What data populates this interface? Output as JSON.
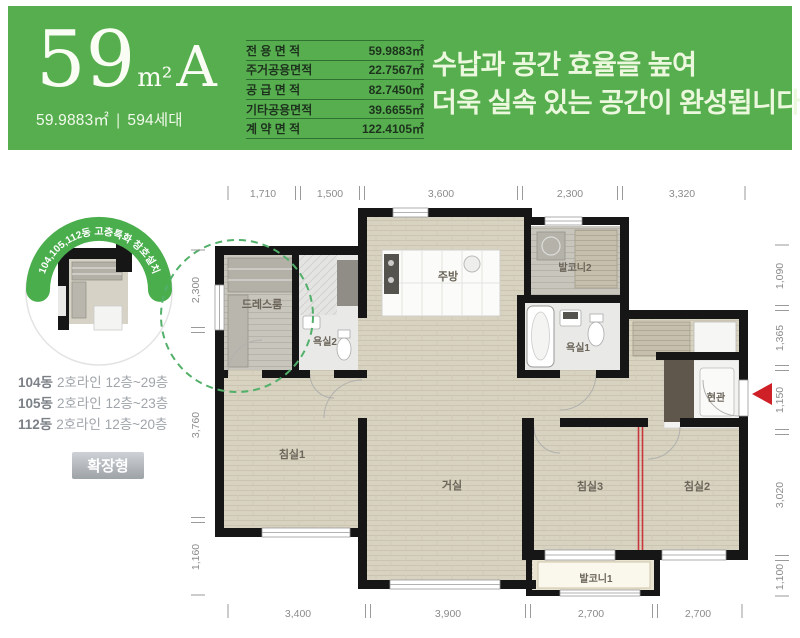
{
  "header": {
    "size_number": "59",
    "size_unit": "m²",
    "size_type": "A",
    "size_detail": "59.9883㎡",
    "divider": "|",
    "households": "594세대",
    "area_table": [
      {
        "label": "전 용 면 적",
        "value": "59.9883㎡"
      },
      {
        "label": "주거공용면적",
        "value": "22.7567㎡"
      },
      {
        "label": "공 급 면 적",
        "value": "82.7450㎡"
      },
      {
        "label": "기타공용면적",
        "value": "39.6655㎡"
      },
      {
        "label": "계 약 면 적",
        "value": "122.4105㎡"
      }
    ],
    "headline_line1": "수납과 공간 효율을 높여",
    "headline_line2": "더욱 실속 있는 공간이 완성됩니다"
  },
  "sidebar": {
    "badge_arc_text": "104,105,112동 고층특화 창호설치",
    "floor_lines": [
      {
        "dong": "104동",
        "detail": "2호라인 12층~29층"
      },
      {
        "dong": "105동",
        "detail": "2호라인 12층~23층"
      },
      {
        "dong": "112동",
        "detail": "2호라인 12층~20층"
      }
    ],
    "type_badge": "확장형"
  },
  "plan": {
    "rooms": {
      "dressroom": "드레스룸",
      "bath2": "욕실2",
      "kitchen": "주방",
      "balcony2": "발코니2",
      "bath1": "욕실1",
      "entrance": "현관",
      "bedroom1": "침실1",
      "living": "거실",
      "bedroom3": "침실3",
      "bedroom2": "침실2",
      "balcony1": "발코니1"
    },
    "dims_top": [
      "1,710",
      "1,500",
      "3,600",
      "2,300",
      "3,320"
    ],
    "dims_bottom": [
      "3,400",
      "3,900",
      "2,700",
      "2,700"
    ],
    "dims_left": [
      "2,300",
      "3,760",
      "1,160"
    ],
    "dims_right": [
      "1,090",
      "1,365",
      "1,150",
      "3,020",
      "1,100"
    ]
  },
  "colors": {
    "banner_green": "#57ae4f",
    "arc_green": "#4aae4d",
    "dashed_green": "#52b06a",
    "accent_red": "#cf2027"
  }
}
